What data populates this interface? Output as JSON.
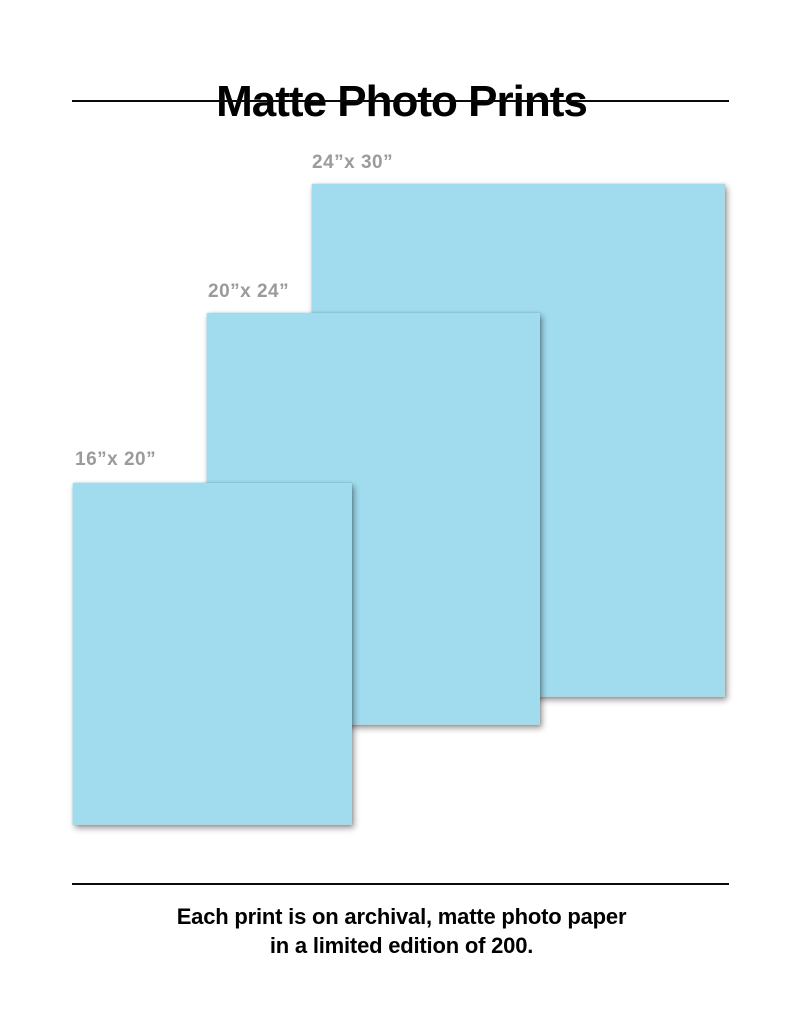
{
  "page": {
    "title": "Matte Photo Prints",
    "footer_line1": "Each print is on archival, matte photo paper",
    "footer_line2": "in a limited edition of 200."
  },
  "colors": {
    "print_fill": "#A1DCEE",
    "label_gray": "#9B9B9B",
    "text_black": "#000000",
    "background": "#FFFFFF"
  },
  "prints": [
    {
      "id": "24x30",
      "label": "24”x 30”",
      "width_in": 24,
      "height_in": 30
    },
    {
      "id": "20x24",
      "label": "20”x 24”",
      "width_in": 20,
      "height_in": 24
    },
    {
      "id": "16x20",
      "label": "16”x 20”",
      "width_in": 16,
      "height_in": 20
    }
  ]
}
